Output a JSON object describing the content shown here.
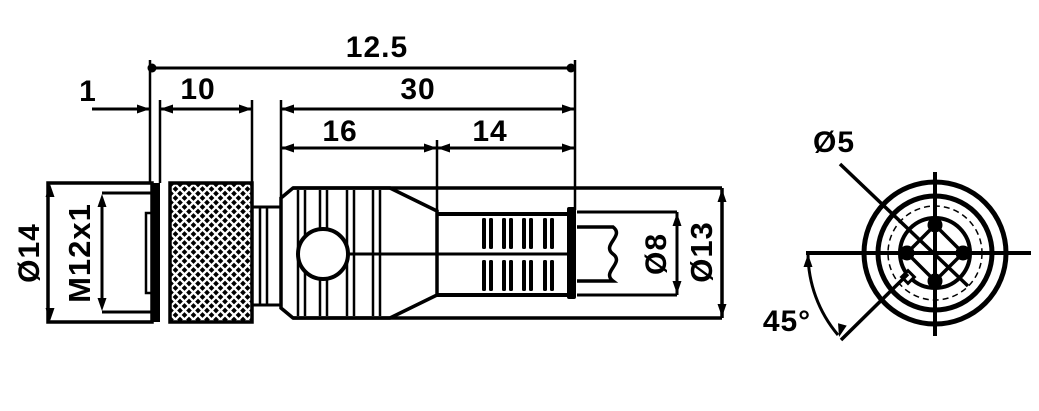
{
  "colors": {
    "ink": "#000000",
    "paper": "#ffffff"
  },
  "side_view": {
    "dimensions": {
      "overall": "12.5",
      "front_lip": "1",
      "nut": "10",
      "body": "30",
      "grip": "16",
      "boot": "14"
    },
    "labels": {
      "nut_diameter": "Ø14",
      "thread": "M12x1",
      "cable_diameter": "Ø8",
      "body_diameter": "Ø13"
    }
  },
  "front_view": {
    "labels": {
      "pin_circle_diameter": "Ø5",
      "keyway_angle": "45°"
    }
  }
}
